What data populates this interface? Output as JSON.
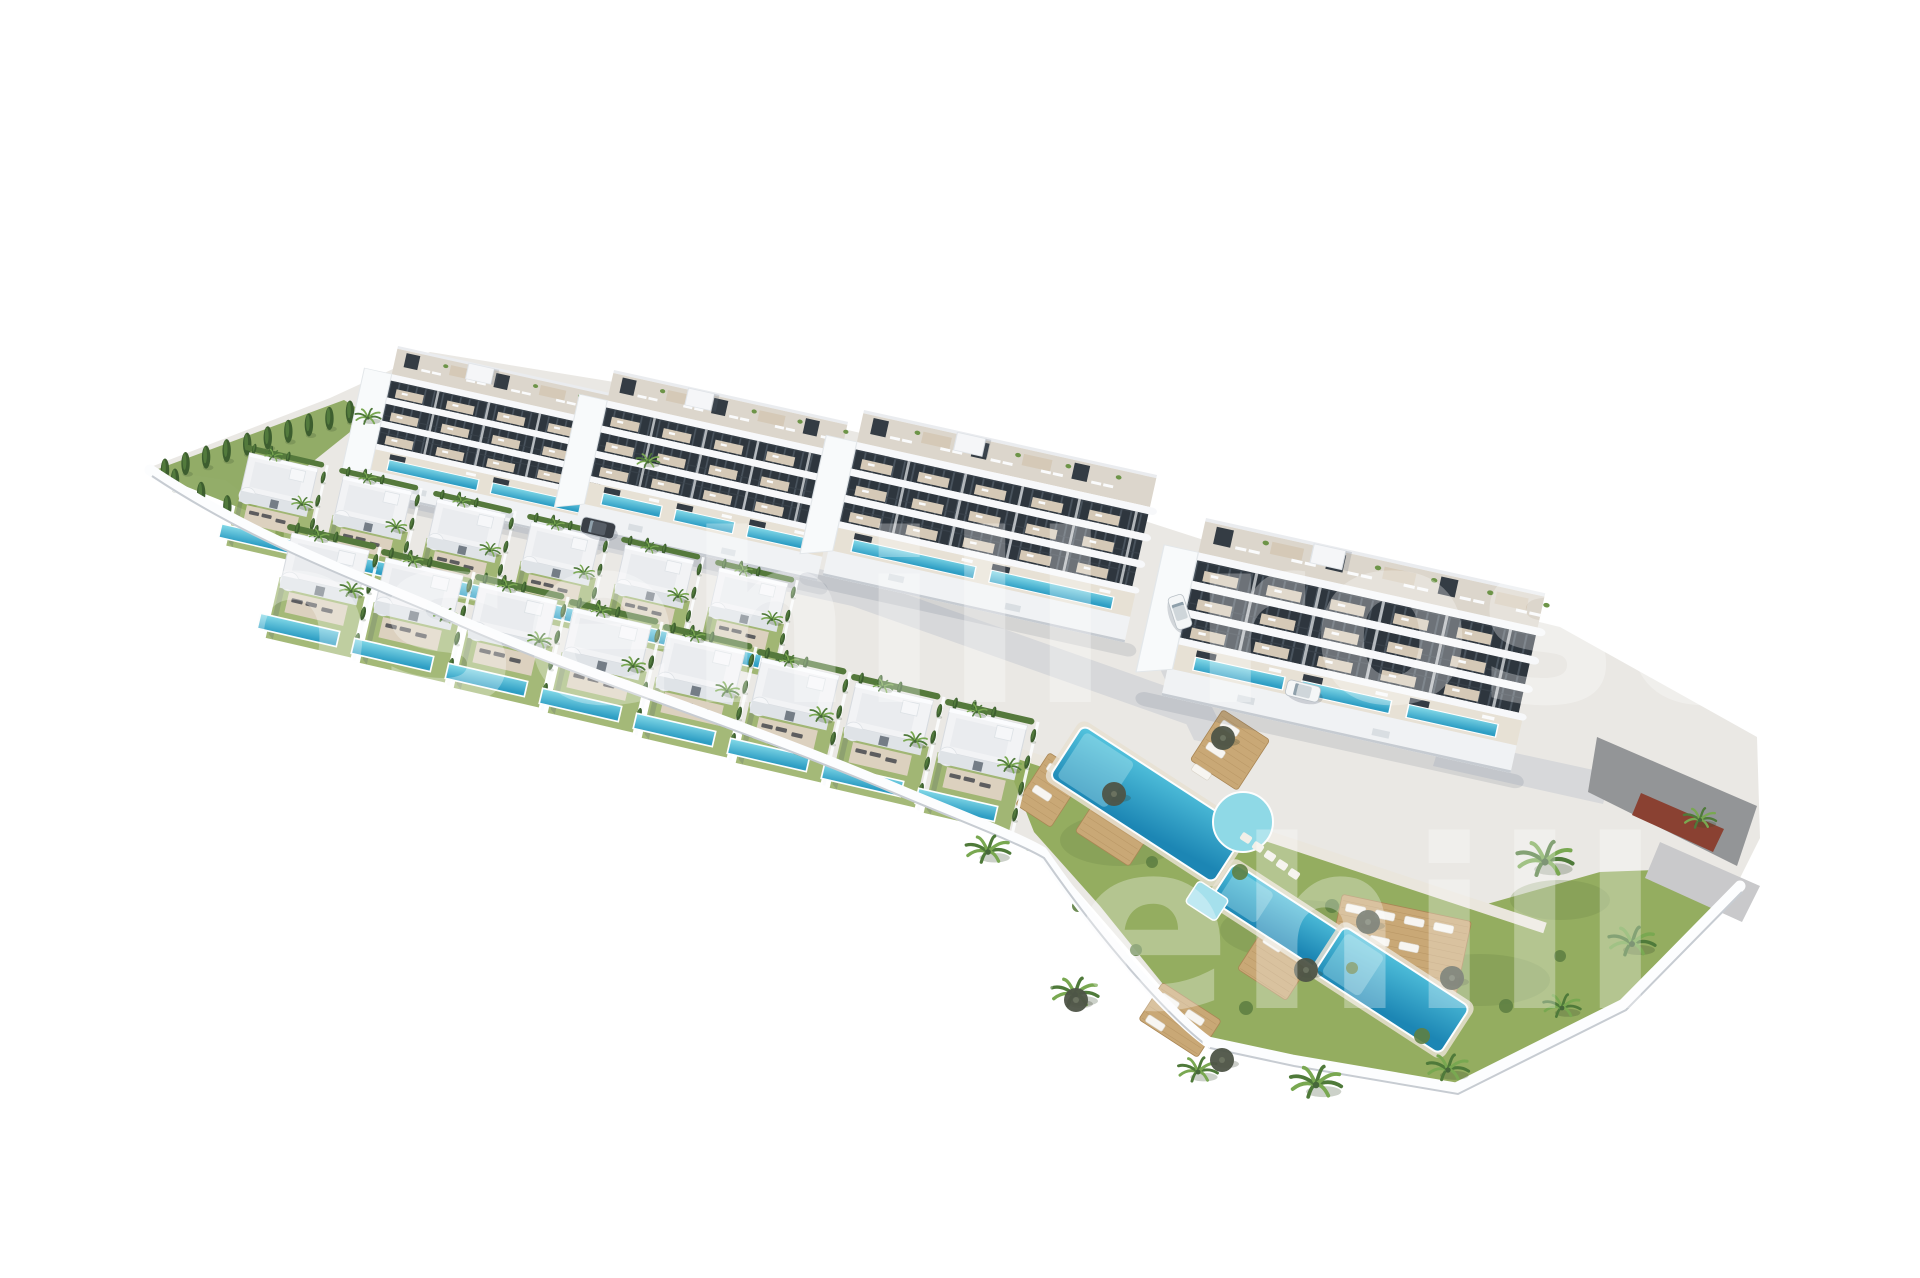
{
  "meta": {
    "description": "Aerial 3D architectural render of a new-build residential development with four apartment blocks, two rows of detached pool villas and a communal lagoon pool garden",
    "background": "#ffffff",
    "canvas": {
      "width": 1920,
      "height": 1278
    }
  },
  "watermark": {
    "text": "rosehill",
    "color": "#ffffff",
    "opacity": 0.3,
    "font_size": 235,
    "letter_spacing": 5,
    "instances": [
      [
        90,
        702
      ],
      [
        1190,
        702
      ],
      [
        640,
        1008
      ]
    ]
  },
  "palette": {
    "ground": "#eae8e4",
    "road": "#d7d8da",
    "roadLight": "#c9c9cb",
    "walk": "#eae6dd",
    "lawn": "#94ad60",
    "lawnDark": "#6f8c48",
    "hedge": "#55793c",
    "cypress": "#3d5e2f",
    "cypressHi": "#527a3c",
    "poolLight": "#86dbe9",
    "poolDark": "#2e9ec4",
    "lagoonLight": "#54c4de",
    "lagoonDark": "#1c86b4",
    "pad": "#8fd9e6",
    "wood": "#c9a876",
    "woodDark": "#a98655",
    "terrace": "#dcd1bf",
    "roofFloor": "#dcd6cc",
    "white": "#f2f3f5",
    "shade": "#dfe3e7",
    "slab": "#f7f8fa",
    "plinth": "#f0f2f4",
    "gable": "#f8fafb",
    "glazing": "#2e363e",
    "slat": "#4a545e",
    "screen": "#343c44",
    "patch": "#d5c9b7",
    "wallWhite": "#fcfdfe",
    "wallEdge": "#c7ccd2",
    "parking": "#939597",
    "brick": "#8a4132",
    "carDark": "#3a3f46",
    "carWhite": "#f4f6f7",
    "carGlass": "#8fa0ab",
    "palmDark": "#4f7a3a",
    "palmLight": "#79a851",
    "trunk": "#9a8a6a",
    "umbrella": "#4e5447",
    "lounger": "#5d5d5f",
    "loungerWhite": "#f7f5f1",
    "shadow": "rgba(80,92,112,0.14)"
  },
  "scene": {
    "site_path": "M148,468 L330,398 L430,352 L700,396 L900,442 L1210,542 L1560,627 L1757,737 L1760,838 L1737,884 L1624,1002 L1456,1086 L1292,1058 L1207,1040 L1042,850 L880,780 L690,702 L558,662 L420,600 L330,558 L225,480 Z",
    "left_strip": "150,472 250,512 370,416 344,400",
    "lawn_path": "M1000,746 L1150,796 L1320,856 L1480,906 L1600,872 L1708,868 L1734,886 L1616,1004 L1455,1084 L1290,1057 L1208,1040 L1100,906 L1034,832 Z",
    "lawn_blobs": [
      [
        1120,
        840,
        60,
        26
      ],
      [
        1300,
        930,
        80,
        30
      ],
      [
        1480,
        980,
        70,
        26
      ],
      [
        1560,
        900,
        50,
        20
      ]
    ],
    "roads": [
      {
        "name": "back-road",
        "points": "380,472 860,578 1205,700 1197,728 852,606 372,500",
        "color": "road"
      },
      {
        "name": "gap-road",
        "points": "1150,648 1188,658 1232,748 1194,740",
        "color": "road"
      },
      {
        "name": "right-road",
        "points": "1442,737 1612,774 1603,804 1433,766",
        "color": "road"
      }
    ],
    "walkway": {
      "path": "M1002,748 L1545,928",
      "width": 11
    },
    "blocks": [
      {
        "name": "apartment-block-1",
        "x": 398,
        "y": 346,
        "sx": 1.0,
        "sy": 0.72,
        "length": 228,
        "pools": 2
      },
      {
        "name": "apartment-block-2",
        "x": 614,
        "y": 370,
        "sx": 1.02,
        "sy": 0.78,
        "length": 235,
        "pools": 3
      },
      {
        "name": "apartment-block-3",
        "x": 864,
        "y": 410,
        "sx": 1.12,
        "sy": 0.82,
        "length": 268,
        "pools": 2
      },
      {
        "name": "apartment-block-4",
        "x": 1206,
        "y": 518,
        "sx": 1.25,
        "sy": 0.88,
        "length": 278,
        "pools": 3
      }
    ],
    "block_rotation": 12.5,
    "villa_rotation": 13,
    "villas": {
      "back_row": {
        "scale": 0.92,
        "positions": [
          [
            246,
            452
          ],
          [
            340,
            475
          ],
          [
            434,
            498
          ],
          [
            528,
            521
          ],
          [
            622,
            544
          ],
          [
            716,
            567
          ]
        ]
      },
      "front_row": {
        "scale": 1.04,
        "positions": [
          [
            288,
            532
          ],
          [
            382,
            557
          ],
          [
            476,
            582
          ],
          [
            570,
            607
          ],
          [
            664,
            632
          ],
          [
            758,
            657
          ],
          [
            852,
            682
          ],
          [
            946,
            707
          ]
        ]
      }
    },
    "cypress_lines": [
      {
        "x1": 165,
        "y1": 470,
        "x2": 350,
        "y2": 412,
        "count": 10
      },
      {
        "x1": 175,
        "y1": 480,
        "x2": 332,
        "y2": 560,
        "count": 7
      }
    ],
    "hedge_dash_path": "M352,576 C500,640 700,715 900,790 C960,815 1000,832 1030,848",
    "pool_complex": {
      "segments": [
        {
          "cx": 1148,
          "cy": 804,
          "w": 195,
          "h": 62,
          "rot": 33
        },
        {
          "cx": 1285,
          "cy": 922,
          "w": 150,
          "h": 44,
          "rot": 33
        },
        {
          "cx": 1392,
          "cy": 990,
          "w": 150,
          "h": 56,
          "rot": 33
        }
      ],
      "pad": {
        "cx": 1243,
        "cy": 822,
        "r": 30
      },
      "spa": {
        "cx": 1207,
        "cy": 901,
        "w": 36,
        "h": 26,
        "rot": 33
      },
      "stones": [
        [
          1246,
          838
        ],
        [
          1258,
          847
        ],
        [
          1270,
          856
        ],
        [
          1282,
          865
        ],
        [
          1294,
          874
        ]
      ]
    },
    "decks": [
      {
        "cx": 1126,
        "cy": 812,
        "w": 64,
        "h": 88,
        "rot": 33,
        "loungers": 4,
        "white": true
      },
      {
        "cx": 1230,
        "cy": 750,
        "w": 56,
        "h": 60,
        "rot": 33,
        "loungers": 3,
        "white": true
      },
      {
        "cx": 1283,
        "cy": 952,
        "w": 58,
        "h": 78,
        "rot": 33,
        "loungers": 2,
        "white": true
      },
      {
        "cx": 1398,
        "cy": 950,
        "w": 132,
        "h": 86,
        "rot": 12,
        "loungers": 7,
        "white": true
      },
      {
        "cx": 1050,
        "cy": 790,
        "w": 42,
        "h": 62,
        "rot": 33,
        "loungers": 2,
        "white": true
      },
      {
        "cx": 1180,
        "cy": 1020,
        "w": 70,
        "h": 44,
        "rot": 33,
        "loungers": 3,
        "white": true
      }
    ],
    "umbrellas": [
      [
        1114,
        794
      ],
      [
        1223,
        738
      ],
      [
        1306,
        970
      ],
      [
        1368,
        922
      ],
      [
        1452,
        978
      ],
      [
        1076,
        1000
      ],
      [
        1222,
        1060
      ]
    ],
    "shrubs": [
      [
        1240,
        872,
        8
      ],
      [
        1332,
        906,
        7
      ],
      [
        1152,
        862,
        6
      ],
      [
        1422,
        1036,
        8
      ],
      [
        1506,
        1006,
        7
      ],
      [
        1560,
        956,
        6
      ],
      [
        1078,
        906,
        6
      ],
      [
        1246,
        1008,
        7
      ],
      [
        1352,
        968,
        6
      ],
      [
        1136,
        950,
        6
      ]
    ],
    "palms": [
      [
        368,
        418,
        0.55
      ],
      [
        648,
        462,
        0.5
      ],
      [
        988,
        852,
        0.95
      ],
      [
        1075,
        995,
        1.0
      ],
      [
        1198,
        1072,
        0.85
      ],
      [
        1316,
        1085,
        1.1
      ],
      [
        1448,
        1070,
        0.9
      ],
      [
        1545,
        862,
        1.2
      ],
      [
        1632,
        944,
        1.0
      ],
      [
        1700,
        820,
        0.7
      ],
      [
        1562,
        1008,
        0.8
      ]
    ],
    "parking": {
      "roof": "1597,737 1757,806 1737,866 1588,792",
      "red_wall": "1641,793 1724,829 1713,852 1632,815",
      "lower_road": "1660,842 1760,886 1742,922 1645,878"
    },
    "boundary_walls": [
      "M150,470 C240,530 330,565 430,607 C560,668 700,707 880,782 C950,812 1015,836 1042,852 C1110,950 1175,1018 1208,1042",
      "M1208,1042 L1292,1060 L1456,1088 L1624,1004 L1740,886"
    ],
    "cars": [
      {
        "x": 598,
        "y": 528,
        "rot": 13,
        "color": "dark"
      },
      {
        "x": 1180,
        "y": 612,
        "rot": 72,
        "color": "white"
      },
      {
        "x": 1303,
        "y": 691,
        "rot": 14,
        "color": "white"
      }
    ]
  }
}
